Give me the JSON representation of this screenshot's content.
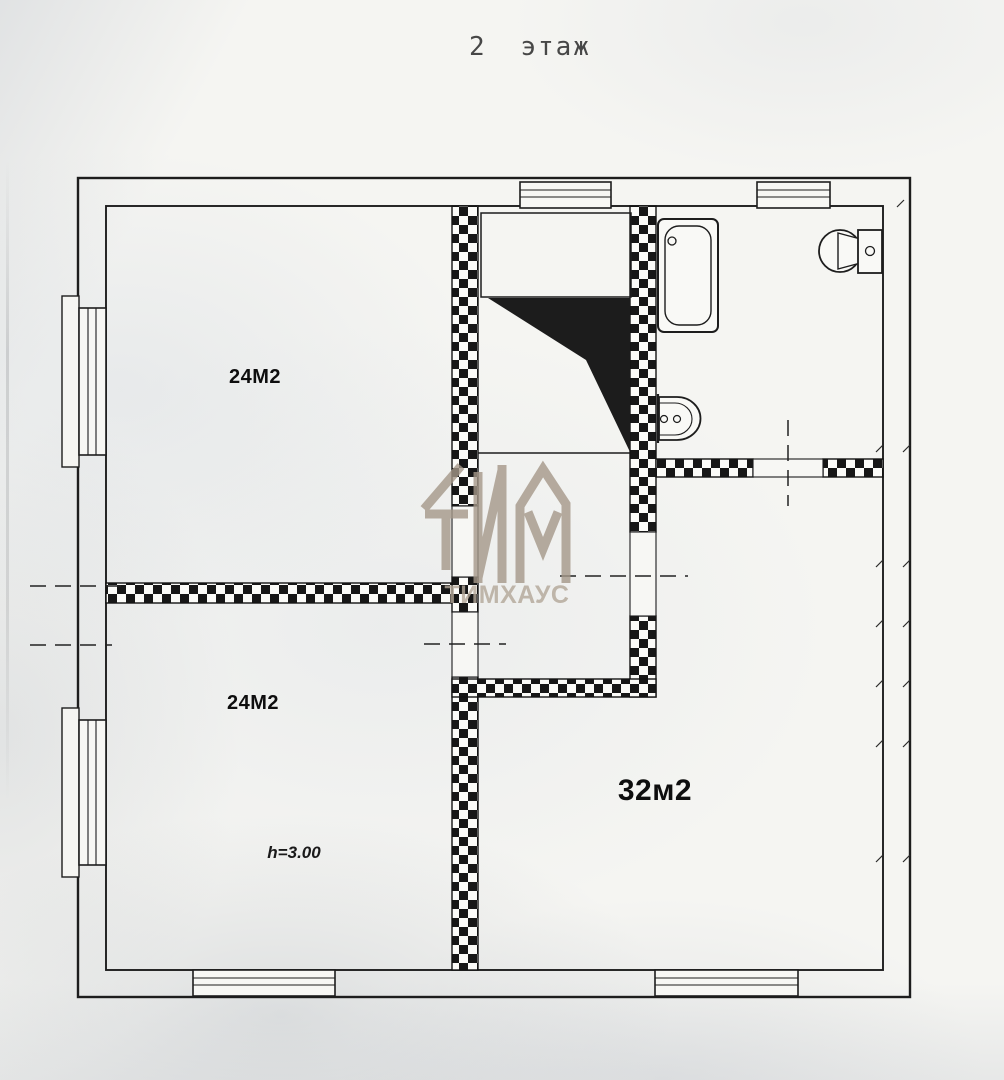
{
  "title": "2 этаж",
  "watermark": {
    "text": "ТИМХАУС",
    "logo": "ТИМ-monogram"
  },
  "rooms": [
    {
      "name": "room-top-left",
      "area_label": "24М2"
    },
    {
      "name": "room-bottom-left",
      "area_label": "24М2"
    },
    {
      "name": "room-bottom-right",
      "area_label": "32м2"
    }
  ],
  "annotations": {
    "ceiling_height": "h=3.00"
  },
  "fixtures": [
    "bathtub",
    "toilet",
    "sink"
  ],
  "colors": {
    "line": "#1d1d1d",
    "paper": "#f5f5f2",
    "wall_fill": "#171717",
    "watermark": "#a59889"
  }
}
